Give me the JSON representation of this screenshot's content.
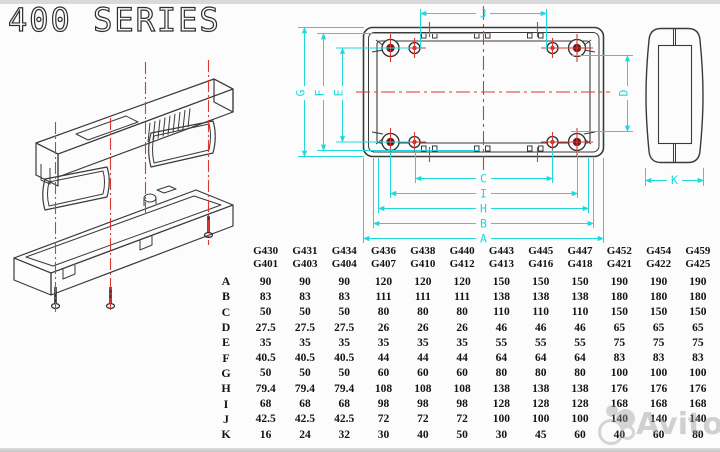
{
  "title": "400 SERIES",
  "drawing": {
    "dim_labels": {
      "A": "A",
      "B": "B",
      "C": "C",
      "D": "D",
      "E": "E",
      "F": "F",
      "G": "G",
      "H": "H",
      "I": "I",
      "J": "J",
      "K": "K"
    },
    "colors": {
      "dimension": "#1fd8dc",
      "centerline": "#d83a32",
      "line": "#3a3a3a",
      "hole_center_dark": "#5e1717",
      "hole_center_red": "#c42a22"
    }
  },
  "table": {
    "models": [
      {
        "top": "G430",
        "bottom": "G401"
      },
      {
        "top": "G431",
        "bottom": "G403"
      },
      {
        "top": "G434",
        "bottom": "G404"
      },
      {
        "top": "G436",
        "bottom": "G407"
      },
      {
        "top": "G438",
        "bottom": "G410"
      },
      {
        "top": "G440",
        "bottom": "G412"
      },
      {
        "top": "G443",
        "bottom": "G413"
      },
      {
        "top": "G445",
        "bottom": "G416"
      },
      {
        "top": "G447",
        "bottom": "G418"
      },
      {
        "top": "G452",
        "bottom": "G421"
      },
      {
        "top": "G454",
        "bottom": "G422"
      },
      {
        "top": "G459",
        "bottom": "G425"
      }
    ],
    "rows": [
      {
        "label": "A",
        "values": [
          "90",
          "90",
          "90",
          "120",
          "120",
          "120",
          "150",
          "150",
          "150",
          "190",
          "190",
          "190"
        ]
      },
      {
        "label": "B",
        "values": [
          "83",
          "83",
          "83",
          "111",
          "111",
          "111",
          "138",
          "138",
          "138",
          "180",
          "180",
          "180"
        ]
      },
      {
        "label": "C",
        "values": [
          "50",
          "50",
          "50",
          "80",
          "80",
          "80",
          "110",
          "110",
          "110",
          "150",
          "150",
          "150"
        ]
      },
      {
        "label": "D",
        "values": [
          "27.5",
          "27.5",
          "27.5",
          "26",
          "26",
          "26",
          "46",
          "46",
          "46",
          "65",
          "65",
          "65"
        ]
      },
      {
        "label": "E",
        "values": [
          "35",
          "35",
          "35",
          "35",
          "35",
          "35",
          "55",
          "55",
          "55",
          "75",
          "75",
          "75"
        ]
      },
      {
        "label": "F",
        "values": [
          "40.5",
          "40.5",
          "40.5",
          "44",
          "44",
          "44",
          "64",
          "64",
          "64",
          "83",
          "83",
          "83"
        ]
      },
      {
        "label": "G",
        "values": [
          "50",
          "50",
          "50",
          "60",
          "60",
          "60",
          "80",
          "80",
          "80",
          "100",
          "100",
          "100"
        ]
      },
      {
        "label": "H",
        "values": [
          "79.4",
          "79.4",
          "79.4",
          "108",
          "108",
          "108",
          "138",
          "138",
          "138",
          "176",
          "176",
          "176"
        ]
      },
      {
        "label": "I",
        "values": [
          "68",
          "68",
          "68",
          "98",
          "98",
          "98",
          "128",
          "128",
          "128",
          "168",
          "168",
          "168"
        ]
      },
      {
        "label": "J",
        "values": [
          "42.5",
          "42.5",
          "42.5",
          "72",
          "72",
          "72",
          "100",
          "100",
          "100",
          "140",
          "140",
          "140"
        ]
      },
      {
        "label": "K",
        "values": [
          "16",
          "24",
          "32",
          "30",
          "40",
          "50",
          "30",
          "45",
          "60",
          "40",
          "60",
          "80"
        ]
      }
    ]
  },
  "watermark": {
    "text": "Avito"
  }
}
